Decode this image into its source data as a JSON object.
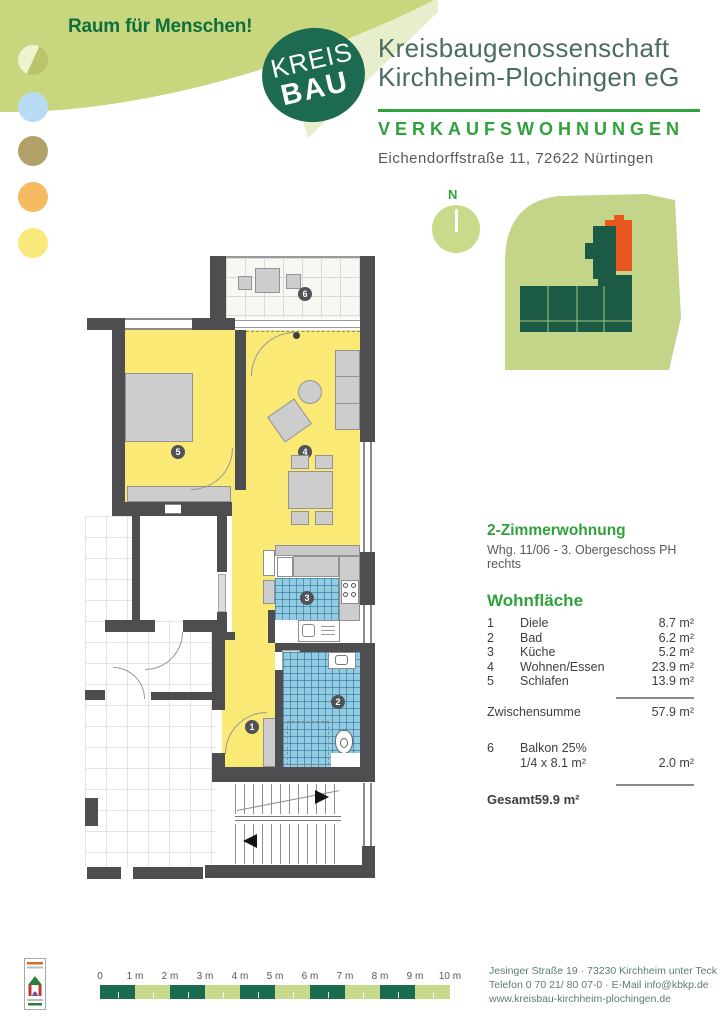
{
  "branding": {
    "tagline": "Raum für Menschen!",
    "logo_line1": "KREIS",
    "logo_line2": "BAU",
    "company_line1": "Kreisbaugenossenschaft",
    "company_line2": "Kirchheim-Plochingen eG",
    "colors": {
      "brand_green": "#2fa23c",
      "logo_green": "#1c6a50",
      "blob_green": "#c8d77e",
      "plan_yellow": "#fae975",
      "tile_blue": "#93cbe3",
      "site_green": "#c2d589",
      "building_green": "#1b5b46",
      "highlight_orange": "#ea561f"
    }
  },
  "header": {
    "category": "VERKAUFSWOHNUNGEN",
    "address": "Eichendorffstraße 11, 72622 Nürtingen"
  },
  "site_plan": {
    "north_label": "N"
  },
  "floor_plan": {
    "badges": [
      "1",
      "2",
      "3",
      "4",
      "5",
      "6"
    ]
  },
  "details": {
    "title": "2-Zimmerwohnung",
    "subtitle": "Whg. 11/06 - 3. Obergeschoss PH rechts",
    "section_title": "Wohnfläche",
    "rooms": [
      {
        "num": "1",
        "name": "Diele",
        "area": "8.7 m²"
      },
      {
        "num": "2",
        "name": "Bad",
        "area": "6.2 m²"
      },
      {
        "num": "3",
        "name": "Küche",
        "area": "5.2 m²"
      },
      {
        "num": "4",
        "name": "Wohnen/Essen",
        "area": "23.9 m²"
      },
      {
        "num": "5",
        "name": "Schlafen",
        "area": "13.9 m²"
      }
    ],
    "subtotal_label": "Zwischensumme",
    "subtotal_value": "57.9 m²",
    "balcony_num": "6",
    "balcony_label": "Balkon 25%",
    "balcony_formula": "1/4 x 8.1 m²",
    "balcony_value": "2.0 m²",
    "total_label": "Gesamt",
    "total_value": "59.9 m²"
  },
  "scale_bar": {
    "labels": [
      "0",
      "1 m",
      "2 m",
      "3 m",
      "4 m",
      "5 m",
      "6 m",
      "7 m",
      "8 m",
      "9 m",
      "10 m"
    ]
  },
  "footer": {
    "address_line": "Jesinger Straße 19 · 73230 Kirchheim unter Teck",
    "contact_line": "Telefon 0 70 21/ 80 07-0 · E-Mail info@kbkp.de",
    "website": "www.kreisbau-kirchheim-plochingen.de"
  }
}
